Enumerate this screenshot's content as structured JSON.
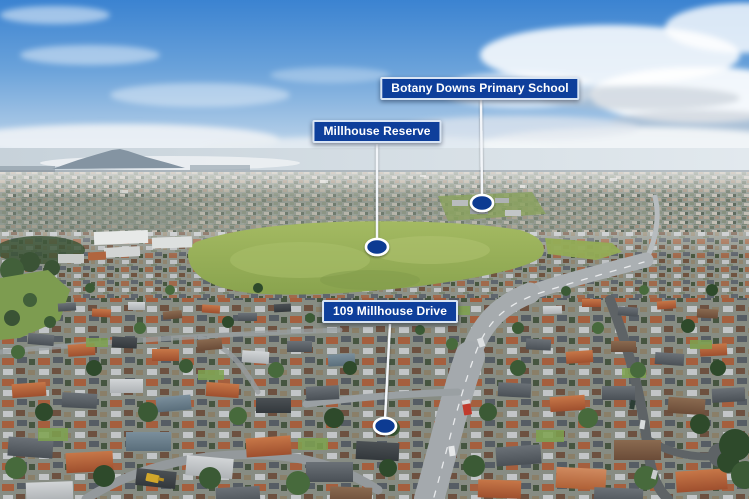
{
  "map": {
    "annotations": [
      {
        "id": "school",
        "label": "Botany Downs Primary School"
      },
      {
        "id": "reserve",
        "label": "Millhouse Reserve"
      },
      {
        "id": "property",
        "label": "109 Millhouse Drive"
      }
    ]
  },
  "colors": {
    "label-bg": "#0e3f9b",
    "label-border": "#d9e5f4",
    "label-text": "#ffffff",
    "marker-fill": "#0b3a92",
    "marker-ring": "#ffffff",
    "leader-line": "#f3f6fa"
  }
}
